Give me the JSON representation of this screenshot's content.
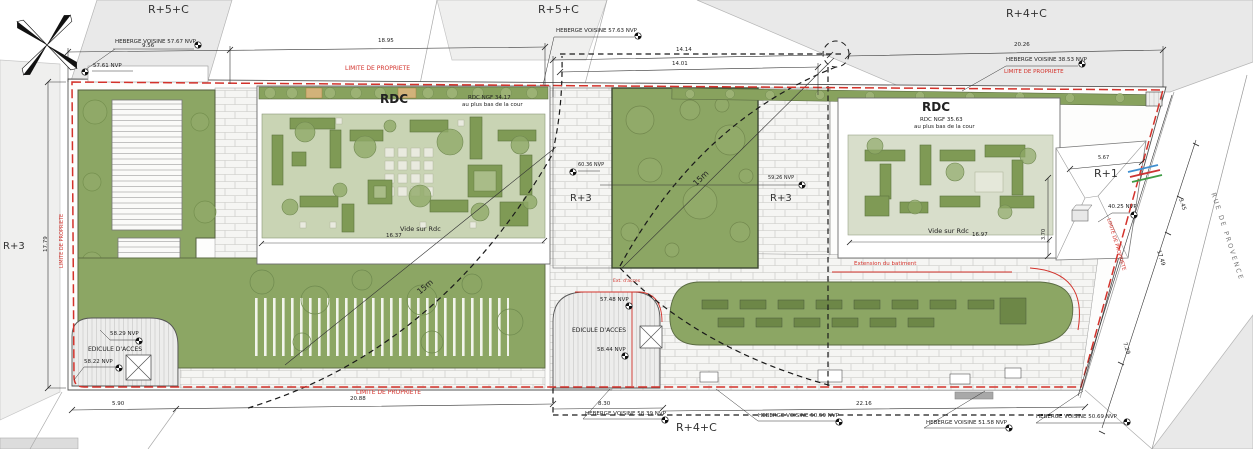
{
  "parcels": {
    "floors": [
      "R+5+C",
      "R+5+C",
      "R+4+C",
      "R+3",
      "R+4+C"
    ]
  },
  "street": {
    "name": "RUE DE PROVENCE"
  },
  "plan": {
    "limite_label": "LIMITE DE PROPRIETE",
    "radius_label": "15m",
    "extension_note": "Extension du batiment",
    "rdc_left": {
      "title": "RDC",
      "ngf": "RDC NGF 34.17",
      "sub": "au plus bas de la cour",
      "vide": "Vide sur Rdc",
      "vide_dim": "16.37"
    },
    "rdc_right": {
      "title": "RDC",
      "ngf": "RDC NGF 35.63",
      "sub": "au plus bas de la cour",
      "vide": "Vide sur Rdc",
      "vide_dim": "16.97"
    },
    "wings": {
      "r1": "R+1",
      "r3_left": "R+3",
      "r3_left_level": "60.36 NVP",
      "r3_right": "R+3",
      "r3_right_level": "59.26 NVP"
    },
    "edicules": {
      "left_label": "EDICULE D'ACCES",
      "left_level_top": "58.29 NVP",
      "left_level_bottom": "58.22 NVP",
      "center_label": "EDICULE D'ACCES",
      "center_level_top": "57.48 NVP",
      "center_level_bottom": "58.44 NVP",
      "center_red_note": "Ext. d'acces"
    },
    "levels": {
      "top_left": "57.61 NVP",
      "r1": "40.25 NVP"
    }
  },
  "heberges": [
    "HEBERGE VOISINE 57.67 NVP",
    "HEBERGE VOISINE 57.63 NVP",
    "HEBERGE VOISINE 38.53 NVP",
    "HEBERGE VOISINE 58.39 NVP",
    "HEBERGE VOISINE 50.59 NVP",
    "HEBERGE VOISINE 51.58 NVP",
    "HEBERGE VOISINE 50.69 NVP"
  ],
  "dimensions": {
    "top": [
      "9.56",
      "18.95",
      "14.14",
      "14.01",
      "20.26"
    ],
    "bottom": [
      "5.90",
      "20.88",
      "8.30",
      "22.16"
    ],
    "left": "17.79",
    "right": [
      "3.45",
      "17.49",
      "7.29"
    ],
    "r1_width": "5.67",
    "r1_depth": "3.70"
  },
  "colors": {
    "property_line": "#d3322b",
    "green_roof": "#8ca664",
    "planter": "#6d8747",
    "parcel_gray": "#e9e9e9"
  }
}
